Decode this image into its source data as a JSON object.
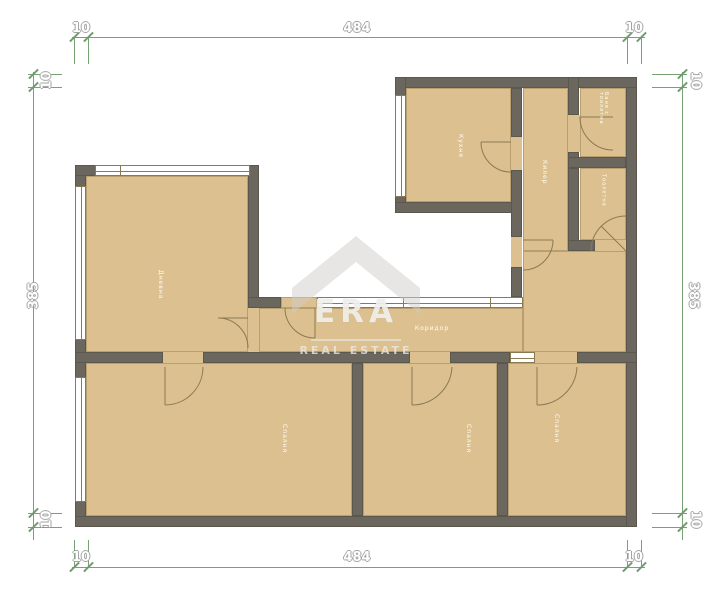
{
  "watermark": {
    "brand": "ERA",
    "tagline": "REAL ESTATE"
  },
  "dimensions": {
    "top": {
      "left": "10",
      "span": "484",
      "right": "10"
    },
    "bottom": {
      "left": "10",
      "span": "484",
      "right": "10"
    },
    "left": {
      "top": "10",
      "span": "385",
      "bottom": "10"
    },
    "right": {
      "top": "10",
      "span": "385",
      "bottom": "10"
    }
  },
  "rooms": {
    "living": {
      "label": "Дневна"
    },
    "kitchen": {
      "label": "Кухня"
    },
    "closet": {
      "label": "Килер"
    },
    "bathroom": {
      "label": "Баня с тоалетна"
    },
    "toilet": {
      "label": "Тоалетна"
    },
    "corridor": {
      "label": "Коридор"
    },
    "bedroom_left": {
      "label": "Спалня"
    },
    "bedroom_middle": {
      "label": "Спалня"
    },
    "bedroom_right": {
      "label": "Спалня"
    }
  },
  "colors": {
    "floor": "#ddc08f",
    "wall": "#6b675e",
    "dimension_green": "#76a276",
    "thin_line": "#8a7a52",
    "background": "#ffffff"
  }
}
